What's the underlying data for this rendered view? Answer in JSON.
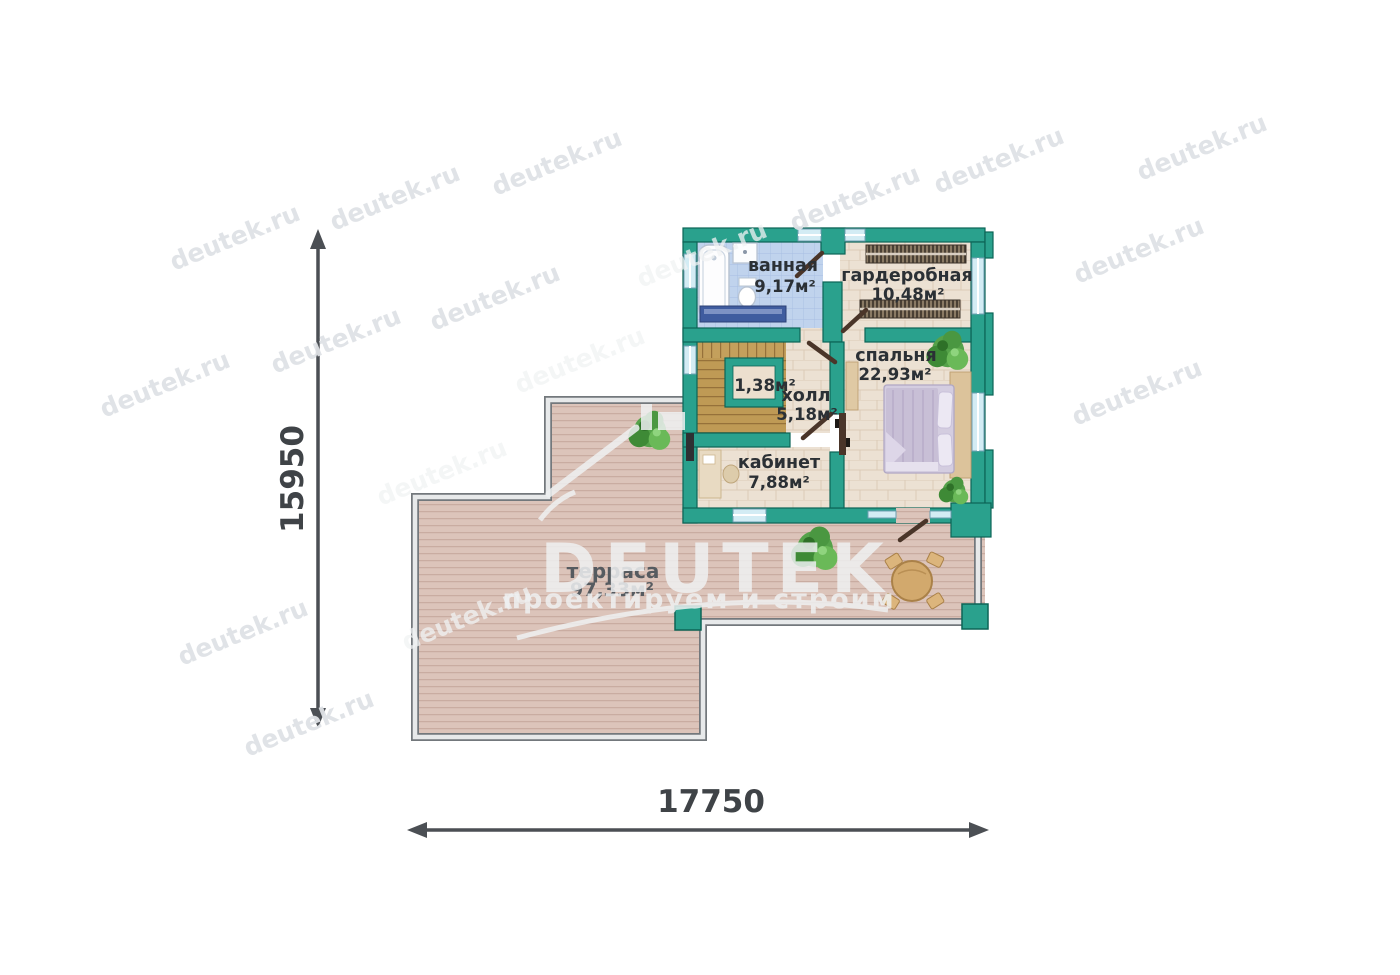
{
  "watermark": {
    "text": "deutek.ru"
  },
  "logo": {
    "name": "DEUTEK",
    "tagline": "проектируем и строим"
  },
  "dimensions": {
    "height": "15950",
    "width": "17750"
  },
  "rooms": {
    "bathroom": {
      "name": "ванная",
      "area": "9,17м²"
    },
    "wardrobe": {
      "name": "гардеробная",
      "area": "10,48м²"
    },
    "bedroom": {
      "name": "спальня",
      "area": "22,93м²"
    },
    "hall": {
      "name": "холл",
      "area": "5,18м²"
    },
    "closet": {
      "area": "1,38м²"
    },
    "office": {
      "name": "кабинет",
      "area": "7,88м²"
    },
    "terrace": {
      "name": "терраса",
      "area": "97,33м²"
    }
  },
  "colors": {
    "wall_teal": "#2aa18d",
    "wall_outline": "#0c6456",
    "window_blue": "#d3ecf4",
    "bath_tile": "#c0d3ed",
    "stone_floor": "#ece1d3",
    "stairs_wood": "#bf9a55",
    "terrace_wood": "#dcc4ba",
    "label_dark": "#2b3035",
    "dimension_gray": "#4b4f54",
    "watermark_gray": "#dfe2e6"
  }
}
